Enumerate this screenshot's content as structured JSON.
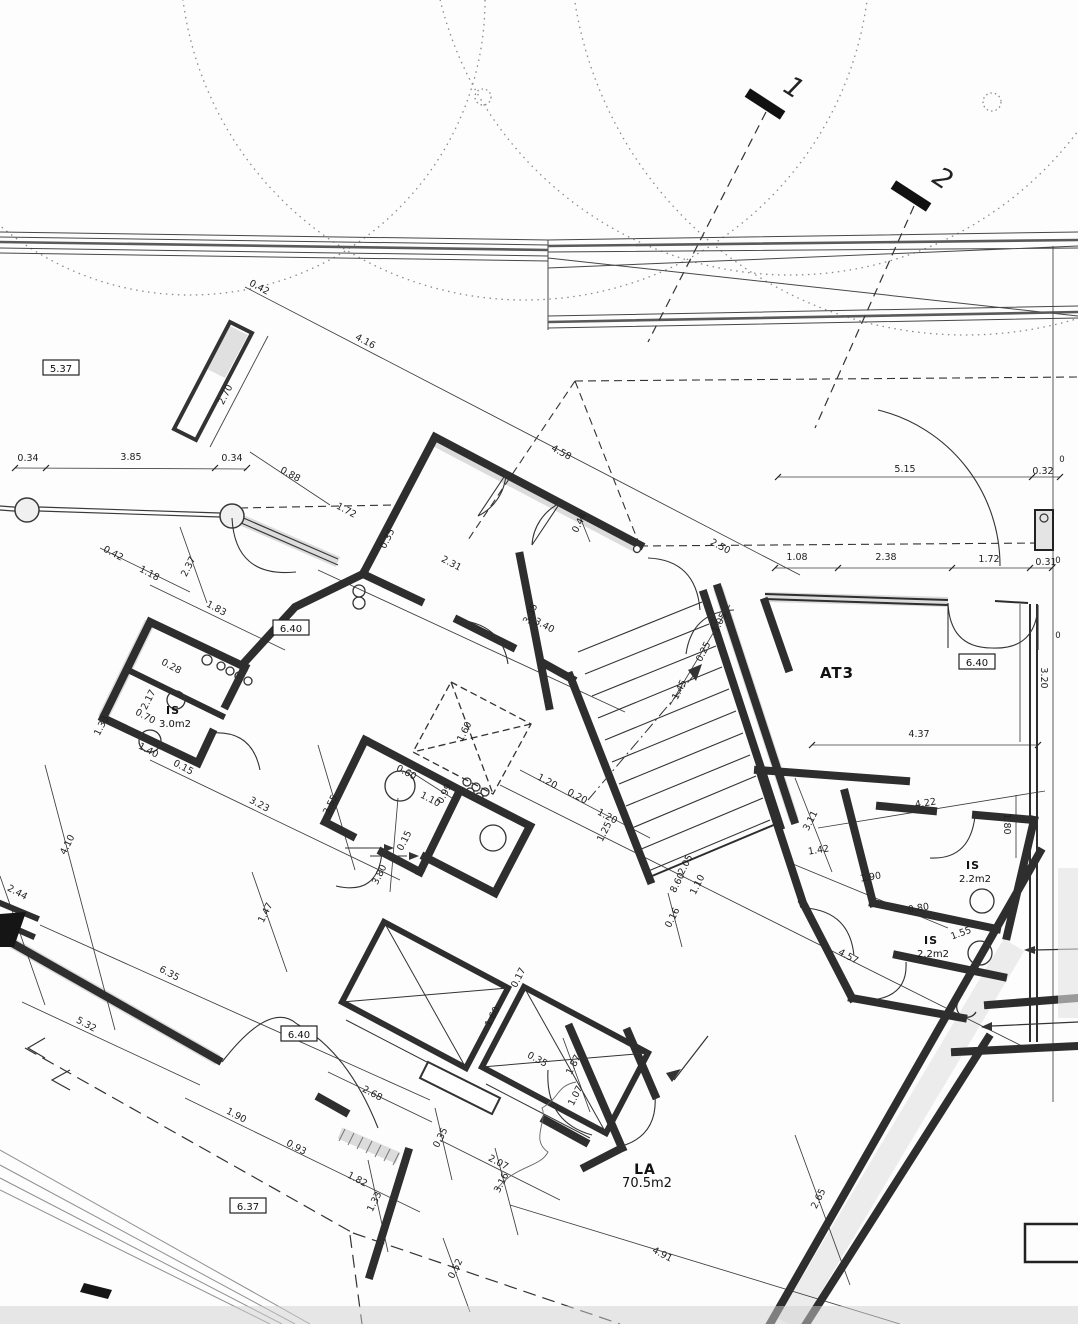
{
  "document": {
    "type": "scanned architectural floor plan",
    "sheet_note": "rotated building plan with site road, trees and property lines"
  },
  "colors": {
    "ink": "#2e2e2e",
    "thin": "#3d3d3d",
    "road": "#555555",
    "hatch": "#dcdcdc",
    "shadow": "#cfcfcf",
    "paper": "#fdfdfd"
  },
  "markers": {
    "m1": "1",
    "m2": "2"
  },
  "levels": [
    {
      "text": "5.37",
      "x": 61,
      "y": 369
    },
    {
      "text": "6.40",
      "x": 291,
      "y": 629
    },
    {
      "text": "6.40",
      "x": 977,
      "y": 663
    },
    {
      "text": "6.40",
      "x": 299,
      "y": 1035
    },
    {
      "text": "6.37",
      "x": 248,
      "y": 1207
    }
  ],
  "rooms": [
    {
      "name": "AT3",
      "area": "",
      "x": 837,
      "y": 678,
      "size": 15
    },
    {
      "name": "IS",
      "area": "3.0m2",
      "x": 173,
      "y": 714,
      "size": 11
    },
    {
      "name": "IS",
      "area": "2.2m2",
      "x": 973,
      "y": 869,
      "size": 11
    },
    {
      "name": "IS",
      "area": "2.2m2",
      "x": 931,
      "y": 944,
      "size": 11
    },
    {
      "name": "LA",
      "area": "70.5m2",
      "x": 645,
      "y": 1174,
      "size": 14
    }
  ],
  "dims": [
    {
      "t": "0.42",
      "x": 258,
      "y": 290,
      "r": 28
    },
    {
      "t": "4.16",
      "x": 364,
      "y": 344,
      "r": 28
    },
    {
      "t": "2.70",
      "x": 228,
      "y": 396,
      "r": -63
    },
    {
      "t": "0.34",
      "x": 28,
      "y": 461,
      "r": 0
    },
    {
      "t": "3.85",
      "x": 131,
      "y": 460,
      "r": 0
    },
    {
      "t": "0.34",
      "x": 232,
      "y": 461,
      "r": 0
    },
    {
      "t": "0.88",
      "x": 289,
      "y": 477,
      "r": 28
    },
    {
      "t": "1.72",
      "x": 345,
      "y": 513,
      "r": 28
    },
    {
      "t": "0.42",
      "x": 112,
      "y": 556,
      "r": 28
    },
    {
      "t": "1.18",
      "x": 148,
      "y": 576,
      "r": 28
    },
    {
      "t": "2.37",
      "x": 191,
      "y": 568,
      "r": -63
    },
    {
      "t": "1.83",
      "x": 215,
      "y": 611,
      "r": 28
    },
    {
      "t": "0.35",
      "x": 390,
      "y": 540,
      "r": -63
    },
    {
      "t": "4.58",
      "x": 560,
      "y": 455,
      "r": 28
    },
    {
      "t": "2.50",
      "x": 719,
      "y": 549,
      "r": 28
    },
    {
      "t": "5.15",
      "x": 905,
      "y": 472,
      "r": 0
    },
    {
      "t": "0.32",
      "x": 1043,
      "y": 474,
      "r": 0
    },
    {
      "t": "1.08",
      "x": 797,
      "y": 560,
      "r": 0
    },
    {
      "t": "2.38",
      "x": 886,
      "y": 560,
      "r": 0
    },
    {
      "t": "1.72",
      "x": 989,
      "y": 562,
      "r": 0
    },
    {
      "t": "0.31",
      "x": 1046,
      "y": 565,
      "r": 0
    },
    {
      "t": "0",
      "x": 1062,
      "y": 462,
      "r": 0
    },
    {
      "t": "0",
      "x": 1058,
      "y": 563,
      "r": 0
    },
    {
      "t": "0",
      "x": 1058,
      "y": 638,
      "r": 0
    },
    {
      "t": "2.31",
      "x": 450,
      "y": 566,
      "r": 28
    },
    {
      "t": "3.35",
      "x": 533,
      "y": 615,
      "r": -63
    },
    {
      "t": "3.40",
      "x": 543,
      "y": 628,
      "r": 28
    },
    {
      "t": "0.44",
      "x": 582,
      "y": 524,
      "r": -63
    },
    {
      "t": "1.05",
      "x": 722,
      "y": 624,
      "r": -63
    },
    {
      "t": "0.25",
      "x": 706,
      "y": 653,
      "r": -63
    },
    {
      "t": "1.45",
      "x": 682,
      "y": 691,
      "r": -63
    },
    {
      "t": "1.20",
      "x": 546,
      "y": 784,
      "r": 28
    },
    {
      "t": "0.20",
      "x": 576,
      "y": 799,
      "r": 28
    },
    {
      "t": "1.20",
      "x": 606,
      "y": 819,
      "r": 28
    },
    {
      "t": "1.25",
      "x": 607,
      "y": 833,
      "r": -63
    },
    {
      "t": "0.99",
      "x": 447,
      "y": 795,
      "r": -63
    },
    {
      "t": "1.10",
      "x": 429,
      "y": 802,
      "r": 28
    },
    {
      "t": "0.15",
      "x": 407,
      "y": 842,
      "r": -63
    },
    {
      "t": "3.80",
      "x": 382,
      "y": 876,
      "r": -63
    },
    {
      "t": "0.60",
      "x": 405,
      "y": 775,
      "r": 28
    },
    {
      "t": "1.10",
      "x": 700,
      "y": 886,
      "r": -63
    },
    {
      "t": "0.16",
      "x": 675,
      "y": 919,
      "r": -63
    },
    {
      "t": "2.05",
      "x": 688,
      "y": 866,
      "r": -63
    },
    {
      "t": "8.60",
      "x": 680,
      "y": 884,
      "r": -63
    },
    {
      "t": "0.17",
      "x": 521,
      "y": 979,
      "r": -63
    },
    {
      "t": "1.60",
      "x": 467,
      "y": 733,
      "r": -63
    },
    {
      "t": "1.60",
      "x": 495,
      "y": 1018,
      "r": -63
    },
    {
      "t": "3.23",
      "x": 258,
      "y": 807,
      "r": 28
    },
    {
      "t": "3.55",
      "x": 333,
      "y": 806,
      "r": -63
    },
    {
      "t": "4.10",
      "x": 70,
      "y": 846,
      "r": -63
    },
    {
      "t": "2.44",
      "x": 16,
      "y": 895,
      "r": 28
    },
    {
      "t": "1.47",
      "x": 268,
      "y": 914,
      "r": -63
    },
    {
      "t": "6.35",
      "x": 168,
      "y": 976,
      "r": 28
    },
    {
      "t": "5.32",
      "x": 85,
      "y": 1027,
      "r": 28
    },
    {
      "t": "2.68",
      "x": 371,
      "y": 1096,
      "r": 28
    },
    {
      "t": "1.90",
      "x": 235,
      "y": 1118,
      "r": 28
    },
    {
      "t": "0.93",
      "x": 295,
      "y": 1150,
      "r": 28
    },
    {
      "t": "1.82",
      "x": 356,
      "y": 1182,
      "r": 28
    },
    {
      "t": "1.33",
      "x": 377,
      "y": 1203,
      "r": -63
    },
    {
      "t": "0.35",
      "x": 443,
      "y": 1139,
      "r": -63
    },
    {
      "t": "2.07",
      "x": 497,
      "y": 1165,
      "r": 28
    },
    {
      "t": "3.16",
      "x": 504,
      "y": 1184,
      "r": -63
    },
    {
      "t": "0.52",
      "x": 458,
      "y": 1270,
      "r": -63
    },
    {
      "t": "4.91",
      "x": 661,
      "y": 1257,
      "r": 28
    },
    {
      "t": "0.35",
      "x": 536,
      "y": 1062,
      "r": 28
    },
    {
      "t": "1.87",
      "x": 576,
      "y": 1066,
      "r": -63
    },
    {
      "t": "1.07",
      "x": 578,
      "y": 1097,
      "r": -63
    },
    {
      "t": "3.11",
      "x": 813,
      "y": 822,
      "r": -63
    },
    {
      "t": "4.22",
      "x": 926,
      "y": 806,
      "r": -9
    },
    {
      "t": "1.42",
      "x": 819,
      "y": 853,
      "r": -9
    },
    {
      "t": "1.90",
      "x": 871,
      "y": 880,
      "r": -9
    },
    {
      "t": "0.80",
      "x": 919,
      "y": 911,
      "r": -9
    },
    {
      "t": "1.80",
      "x": 1004,
      "y": 824,
      "r": 90
    },
    {
      "t": "3.20",
      "x": 1041,
      "y": 678,
      "r": 90
    },
    {
      "t": "4.37",
      "x": 919,
      "y": 737,
      "r": 0
    },
    {
      "t": "4.57",
      "x": 847,
      "y": 959,
      "r": 28
    },
    {
      "t": "2.65",
      "x": 821,
      "y": 1200,
      "r": -63
    },
    {
      "t": "1.55",
      "x": 962,
      "y": 936,
      "r": -20
    },
    {
      "t": "2.17",
      "x": 151,
      "y": 701,
      "r": -63
    },
    {
      "t": "0.70",
      "x": 144,
      "y": 719,
      "r": 28
    },
    {
      "t": "1.40",
      "x": 147,
      "y": 753,
      "r": 28
    },
    {
      "t": "1.33",
      "x": 104,
      "y": 727,
      "r": -63
    },
    {
      "t": "0.28",
      "x": 170,
      "y": 669,
      "r": 28
    },
    {
      "t": "0.15",
      "x": 182,
      "y": 770,
      "r": 28
    }
  ]
}
